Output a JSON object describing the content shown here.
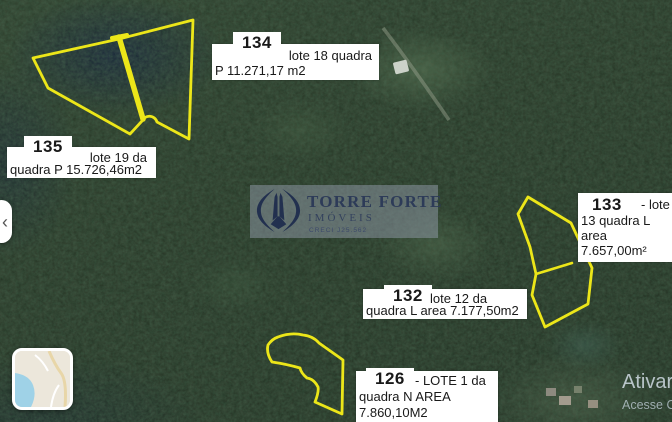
{
  "lots": {
    "l134": {
      "number": "134",
      "text1": "lote 18 quadra",
      "text2": "P 11.271,17 m2"
    },
    "l135": {
      "number": "135",
      "text1": "lote 19 da",
      "text2": "quadra P 15.726,46m2"
    },
    "l133": {
      "number": "133",
      "text1": "- lote",
      "text2": "13 quadra L",
      "text3": "area",
      "text4": "7.657,00m²"
    },
    "l132": {
      "number": "132",
      "text1": "lote 12 da",
      "text2": "quadra L area 7.177,50m2"
    },
    "l126": {
      "number": "126",
      "text1": "- LOTE 1 da",
      "text2": "quadra N AREA",
      "text3": "7.860,10M2"
    }
  },
  "watermark": {
    "brand": "TORRE FORTE",
    "subtitle": "IMÓVEIS",
    "creci": "CRECI J25.562"
  },
  "windows": {
    "line1": "Ativar",
    "line2": "Acesse C"
  },
  "controls": {
    "prev_arrow": "‹"
  },
  "colors": {
    "lot_outline": "#ece619",
    "label_bg": "#ffffff",
    "watermark_navy": "#22304f",
    "water_blue": "#9fd2e7"
  }
}
